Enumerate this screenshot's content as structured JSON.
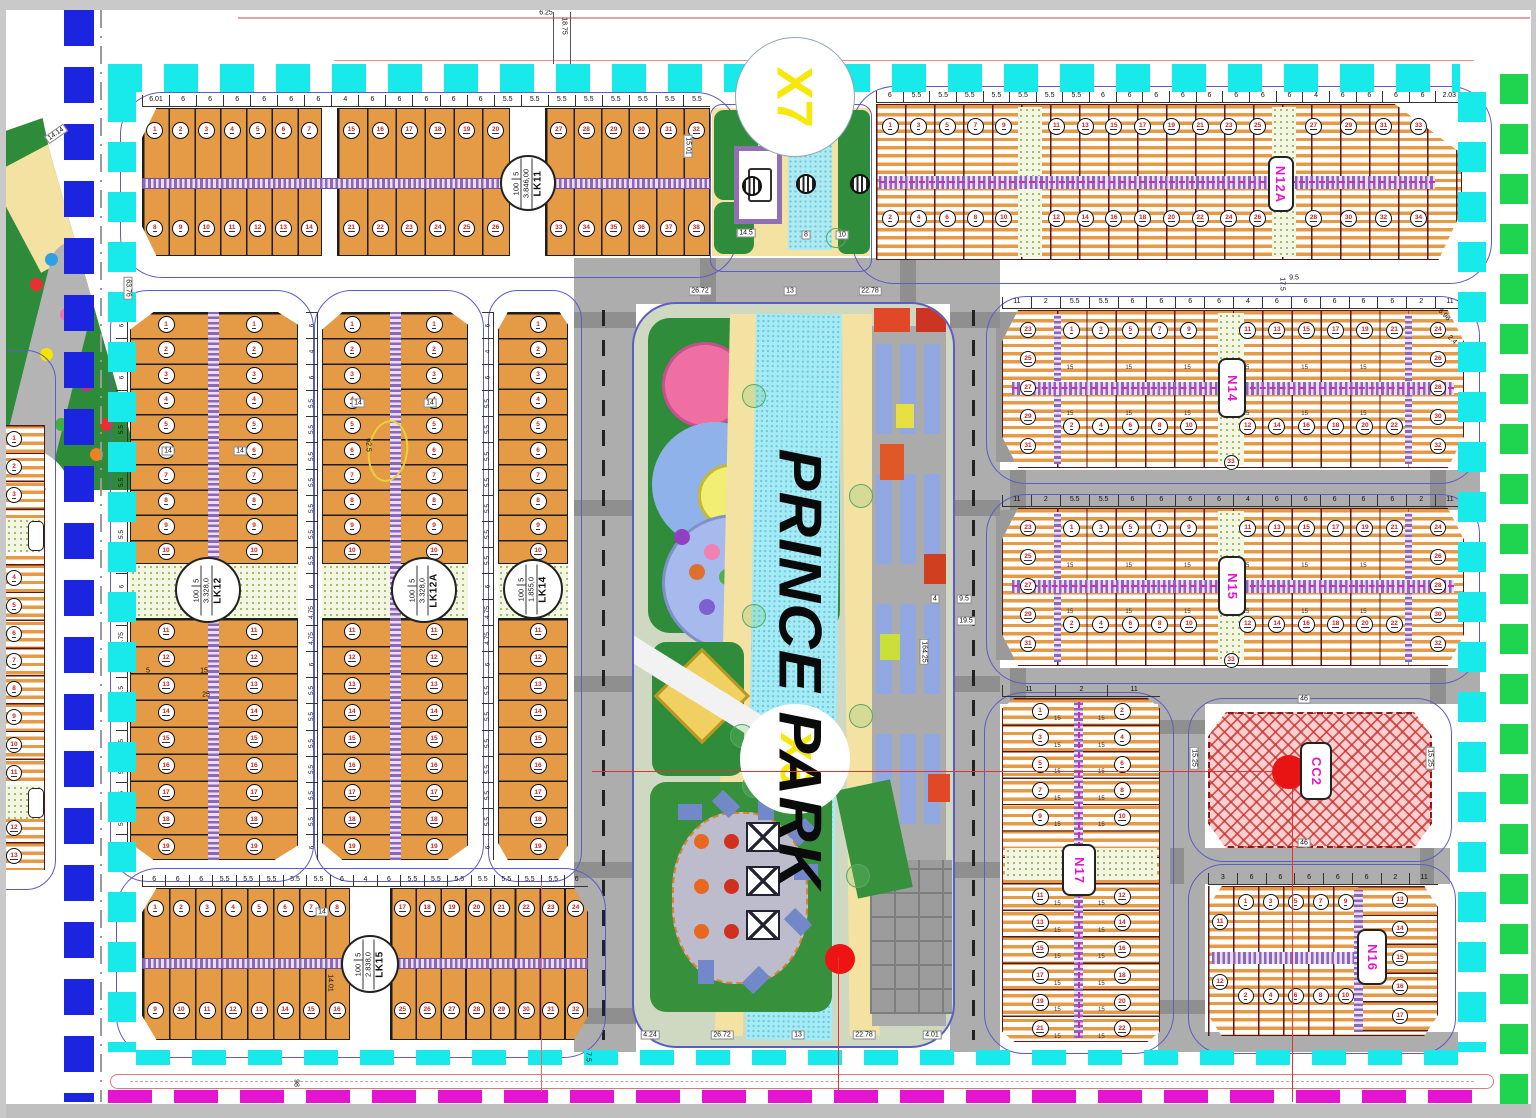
{
  "title": "PRINCE PARK residential master plan",
  "park": {
    "watermark": "PRINCE PARK",
    "circle_label": "X6"
  },
  "junction_label": "X7",
  "blocks": {
    "lk11": {
      "name": "LK11",
      "area": "3.846,00",
      "density": "100",
      "floors": "5"
    },
    "lk12": {
      "name": "LK12",
      "area": "3.328,0",
      "density": "100",
      "floors": "5"
    },
    "lk12a": {
      "name": "LK12A",
      "area": "3.328,0",
      "density": "100",
      "floors": "5"
    },
    "lk14": {
      "name": "LK14",
      "area": "1.855,0",
      "density": "100",
      "floors": "5"
    },
    "lk15": {
      "name": "LK15",
      "area": "2.838,0",
      "density": "100",
      "floors": "5"
    },
    "n12a": {
      "name": "N12A"
    },
    "n14": {
      "name": "N14"
    },
    "n15": {
      "name": "N15"
    },
    "n17": {
      "name": "N17"
    },
    "n16": {
      "name": "N16"
    },
    "cc2": {
      "name": "CC2"
    }
  },
  "dims": {
    "lk11_top": [
      "6.01",
      "6",
      "6",
      "6",
      "6",
      "6",
      "6",
      "4",
      "6",
      "6",
      "6",
      "6",
      "6",
      "5.5",
      "5.5",
      "5.5",
      "5.5",
      "5.5",
      "5.5",
      "5.5",
      "5.5"
    ],
    "n12a_top": [
      "6",
      "5.5",
      "5.5",
      "5.5",
      "5.5",
      "5.5",
      "5.5",
      "5.5",
      "6",
      "6",
      "6",
      "6",
      "6",
      "6",
      "6",
      "6",
      "4",
      "6",
      "6",
      "6",
      "6",
      "2.03"
    ],
    "n14_top": [
      "11",
      "2",
      "5.5",
      "5.5",
      "6",
      "6",
      "6",
      "6",
      "4",
      "6",
      "6",
      "6",
      "6",
      "6",
      "2",
      "11"
    ],
    "n15_top": [
      "11",
      "2",
      "5.5",
      "5.5",
      "6",
      "6",
      "6",
      "6",
      "4",
      "6",
      "6",
      "6",
      "6",
      "6",
      "2",
      "11"
    ],
    "n17_top": [
      "11",
      "2",
      "11"
    ],
    "n16_top": [
      "3",
      "6",
      "6",
      "6",
      "6",
      "6",
      "2",
      "11"
    ],
    "lk15_top": [
      "6",
      "6",
      "6",
      "5.5",
      "5.5",
      "5.5",
      "5.5",
      "5.5",
      "6",
      "4",
      "6",
      "5.5",
      "5.5",
      "5.5",
      "5.5",
      "5.5",
      "5.5",
      "5.5",
      "6"
    ],
    "lk12_side": [
      "6",
      "4",
      "6",
      "5.5",
      "5.5",
      "5.5",
      "5.5",
      "5.5",
      "5.5",
      "5.5",
      "6",
      "4.75",
      "4.75",
      "6",
      "5.5",
      "5.5",
      "5.5",
      "5.5",
      "5.5",
      "5.5",
      "6"
    ],
    "lot_depth": "15"
  },
  "labels": [
    "15.01",
    "14.5",
    "8",
    "10",
    "14.14",
    "63.76",
    "26.72",
    "13",
    "22.78",
    "4.24",
    "26.72",
    "13",
    "22.78",
    "4.01",
    "4",
    "9.5",
    "19.5",
    "164.25",
    "5",
    "15",
    "25",
    "18.75",
    "6.25",
    "17.5",
    "9.5",
    "7.5",
    "98",
    "46",
    "46",
    "15.25",
    "15.25",
    "14",
    "14.01",
    "14",
    "14",
    "14",
    "14",
    "62.5",
    "5.98",
    "2.4"
  ]
}
